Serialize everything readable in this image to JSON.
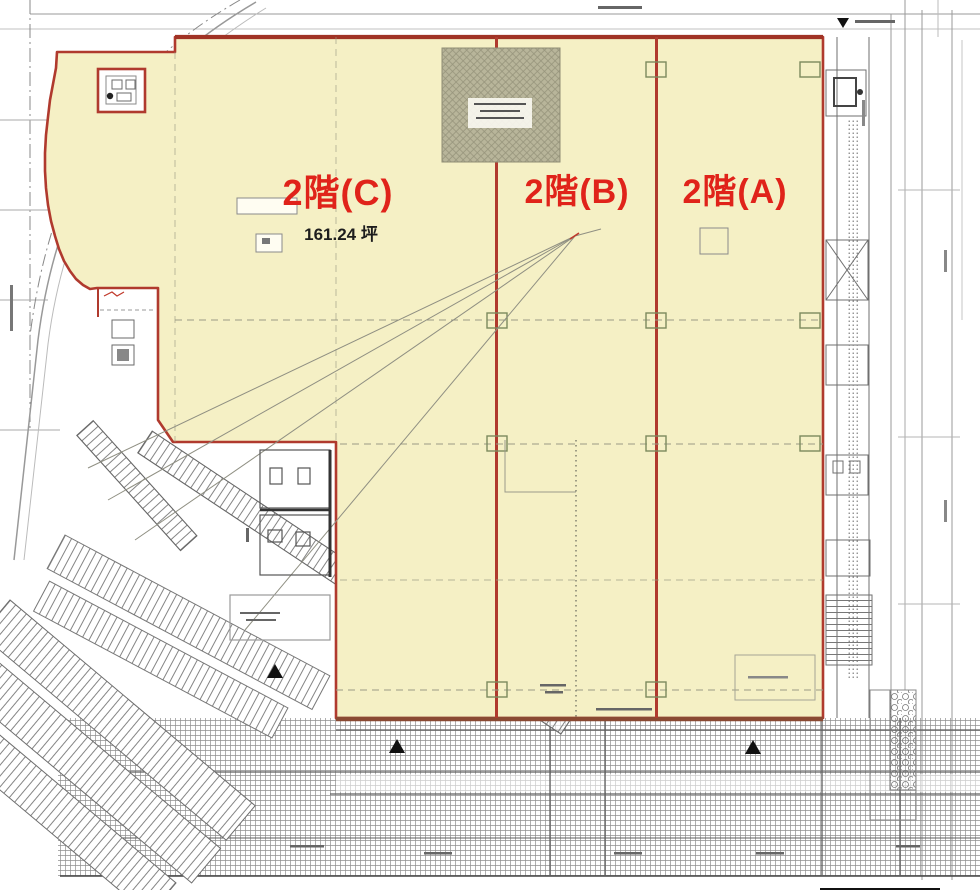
{
  "plan": {
    "zones": {
      "c": {
        "label": "2階(C)",
        "area": "161.24 坪"
      },
      "b": {
        "label": "2階(B)"
      },
      "a": {
        "label": "2階(A)"
      }
    },
    "icons": {
      "up_triangle": "▲",
      "down_triangle": "▼"
    },
    "colors": {
      "zone_fill": "#f5f0c5",
      "boundary_red": "#b03a2e",
      "label_red": "#e0231a",
      "hatch_box_fill": "#b8b59a"
    }
  }
}
